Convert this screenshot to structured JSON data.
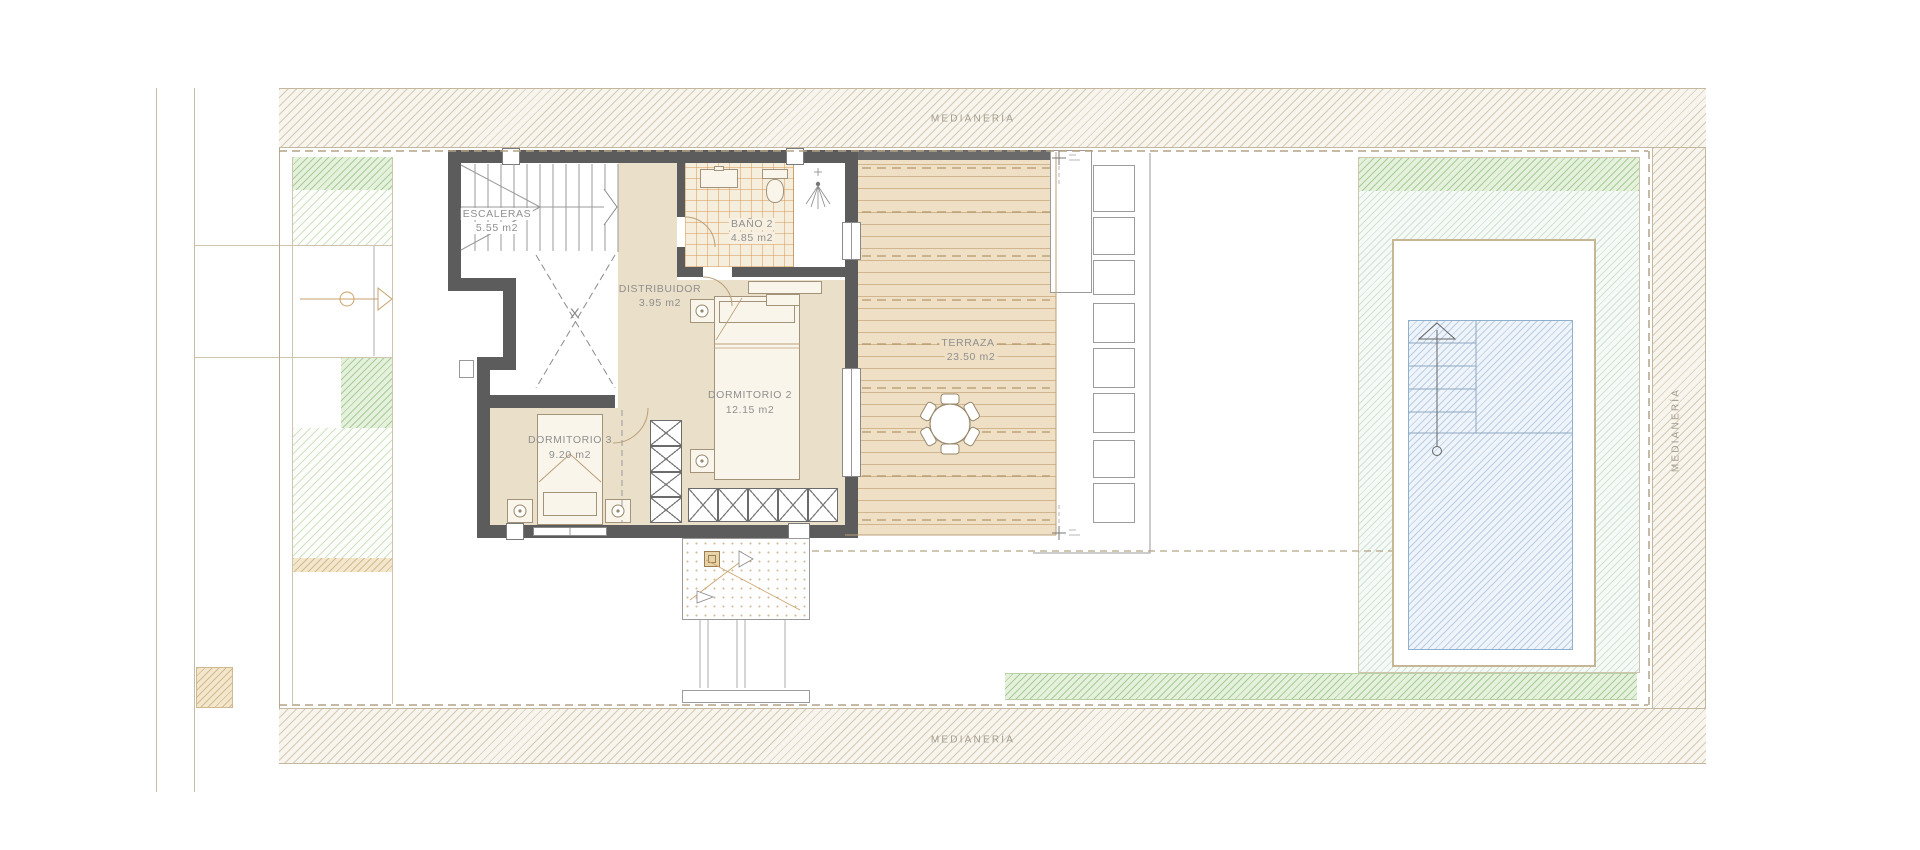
{
  "plan": {
    "party_wall_label_top": "MEDIANERÍA",
    "party_wall_label_bottom": "MEDIANERÍA",
    "party_wall_label_right": "MEDIANERÍA"
  },
  "rooms": {
    "escaleras": {
      "name": "ESCALERAS",
      "area": "5.55 m2"
    },
    "bano2": {
      "name": "BAÑO 2",
      "area": "4.85 m2"
    },
    "distribuidor": {
      "name": "DISTRIBUIDOR",
      "area": "3.95 m2"
    },
    "dormitorio2": {
      "name": "DORMITORIO 2",
      "area": "12.15 m2"
    },
    "dormitorio3": {
      "name": "DORMITORIO 3",
      "area": "9.20 m2"
    },
    "terraza": {
      "name": "TERRAZA",
      "area": "23.50 m2"
    }
  },
  "stairs": {
    "void_marker": "X"
  },
  "colors": {
    "wall": "#5c5c5c",
    "floor": "#eadfc9",
    "deck": "#efe0c5",
    "deck-line": "#c8a87c",
    "label": "#8f8f8f",
    "medianeria-label": "#a39c8e",
    "kerb": "#b3a385",
    "hatch-tan": "#f8f5ee",
    "green-dark": "#9cc98c",
    "green-light": "#cde4c4",
    "pool-water": "#eef4fa",
    "pool-hatch": "#b7cfe6",
    "tile-line": "#dca768"
  }
}
